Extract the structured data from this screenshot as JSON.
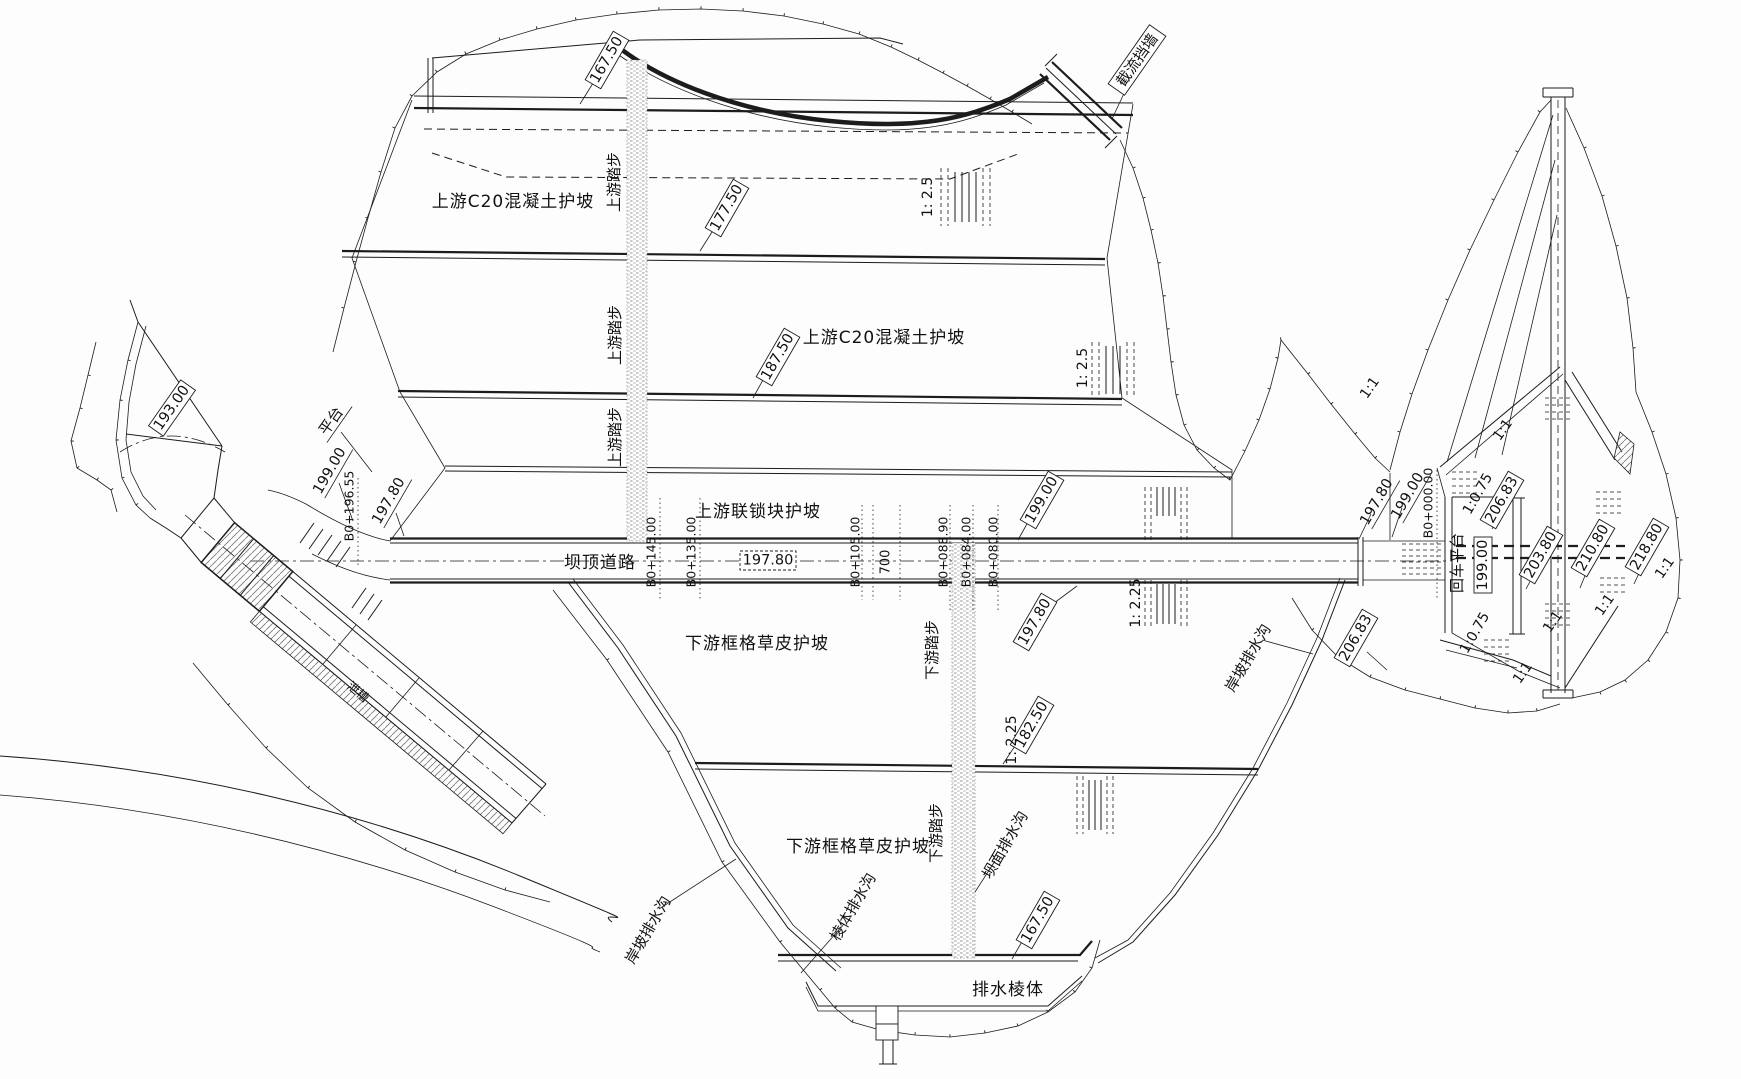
{
  "areas": {
    "upstream_c20_upper": "上游C20混凝土护坡",
    "upstream_c20_lower": "上游C20混凝土护坡",
    "upstream_interlock": "上游联锁块护坡",
    "crest_road": "坝顶道路",
    "downstream_grass_upper": "下游框格草皮护坡",
    "downstream_grass_lower": "下游框格草皮护坡",
    "drainage_prism": "排水棱体",
    "turnaround_platform": "回车平台",
    "platform": "平台",
    "closure_wall": "截流挡墙",
    "chute": "泄槽"
  },
  "steps": {
    "upstream": "上游踏步",
    "downstream": "下游踏步"
  },
  "ditches": {
    "dam_face": "坝面排水沟",
    "prism": "棱体排水沟",
    "bank_left": "岸坡排水沟",
    "bank_right": "岸坡排水沟"
  },
  "elevations": {
    "v167_50": "167.50",
    "v177_50": "177.50",
    "v187_50": "187.50",
    "v182_50": "182.50",
    "v193_00": "193.00",
    "v197_80": "197.80",
    "v199_00": "199.00",
    "v203_80": "203.80",
    "v206_83": "206.83",
    "v210_80": "210.80",
    "v218_80": "218.80"
  },
  "stations": {
    "b0_196_55": "B0+196.55",
    "b0_145": "B0+145.00",
    "b0_135": "B0+135.00",
    "b0_105": "B0+105.00",
    "b0_088_90": "B0+088.90",
    "b0_084": "B0+084.00",
    "b0_080": "B0+080.00",
    "b0_000": "B0+000.00"
  },
  "slopes": {
    "ratio_2_5": "1: 2.5",
    "ratio_2_25": "1: 2.25",
    "ratio_0_75": "1:0.75",
    "ratio_1_1": "1:1"
  },
  "dimensions": {
    "road_width": "700"
  }
}
